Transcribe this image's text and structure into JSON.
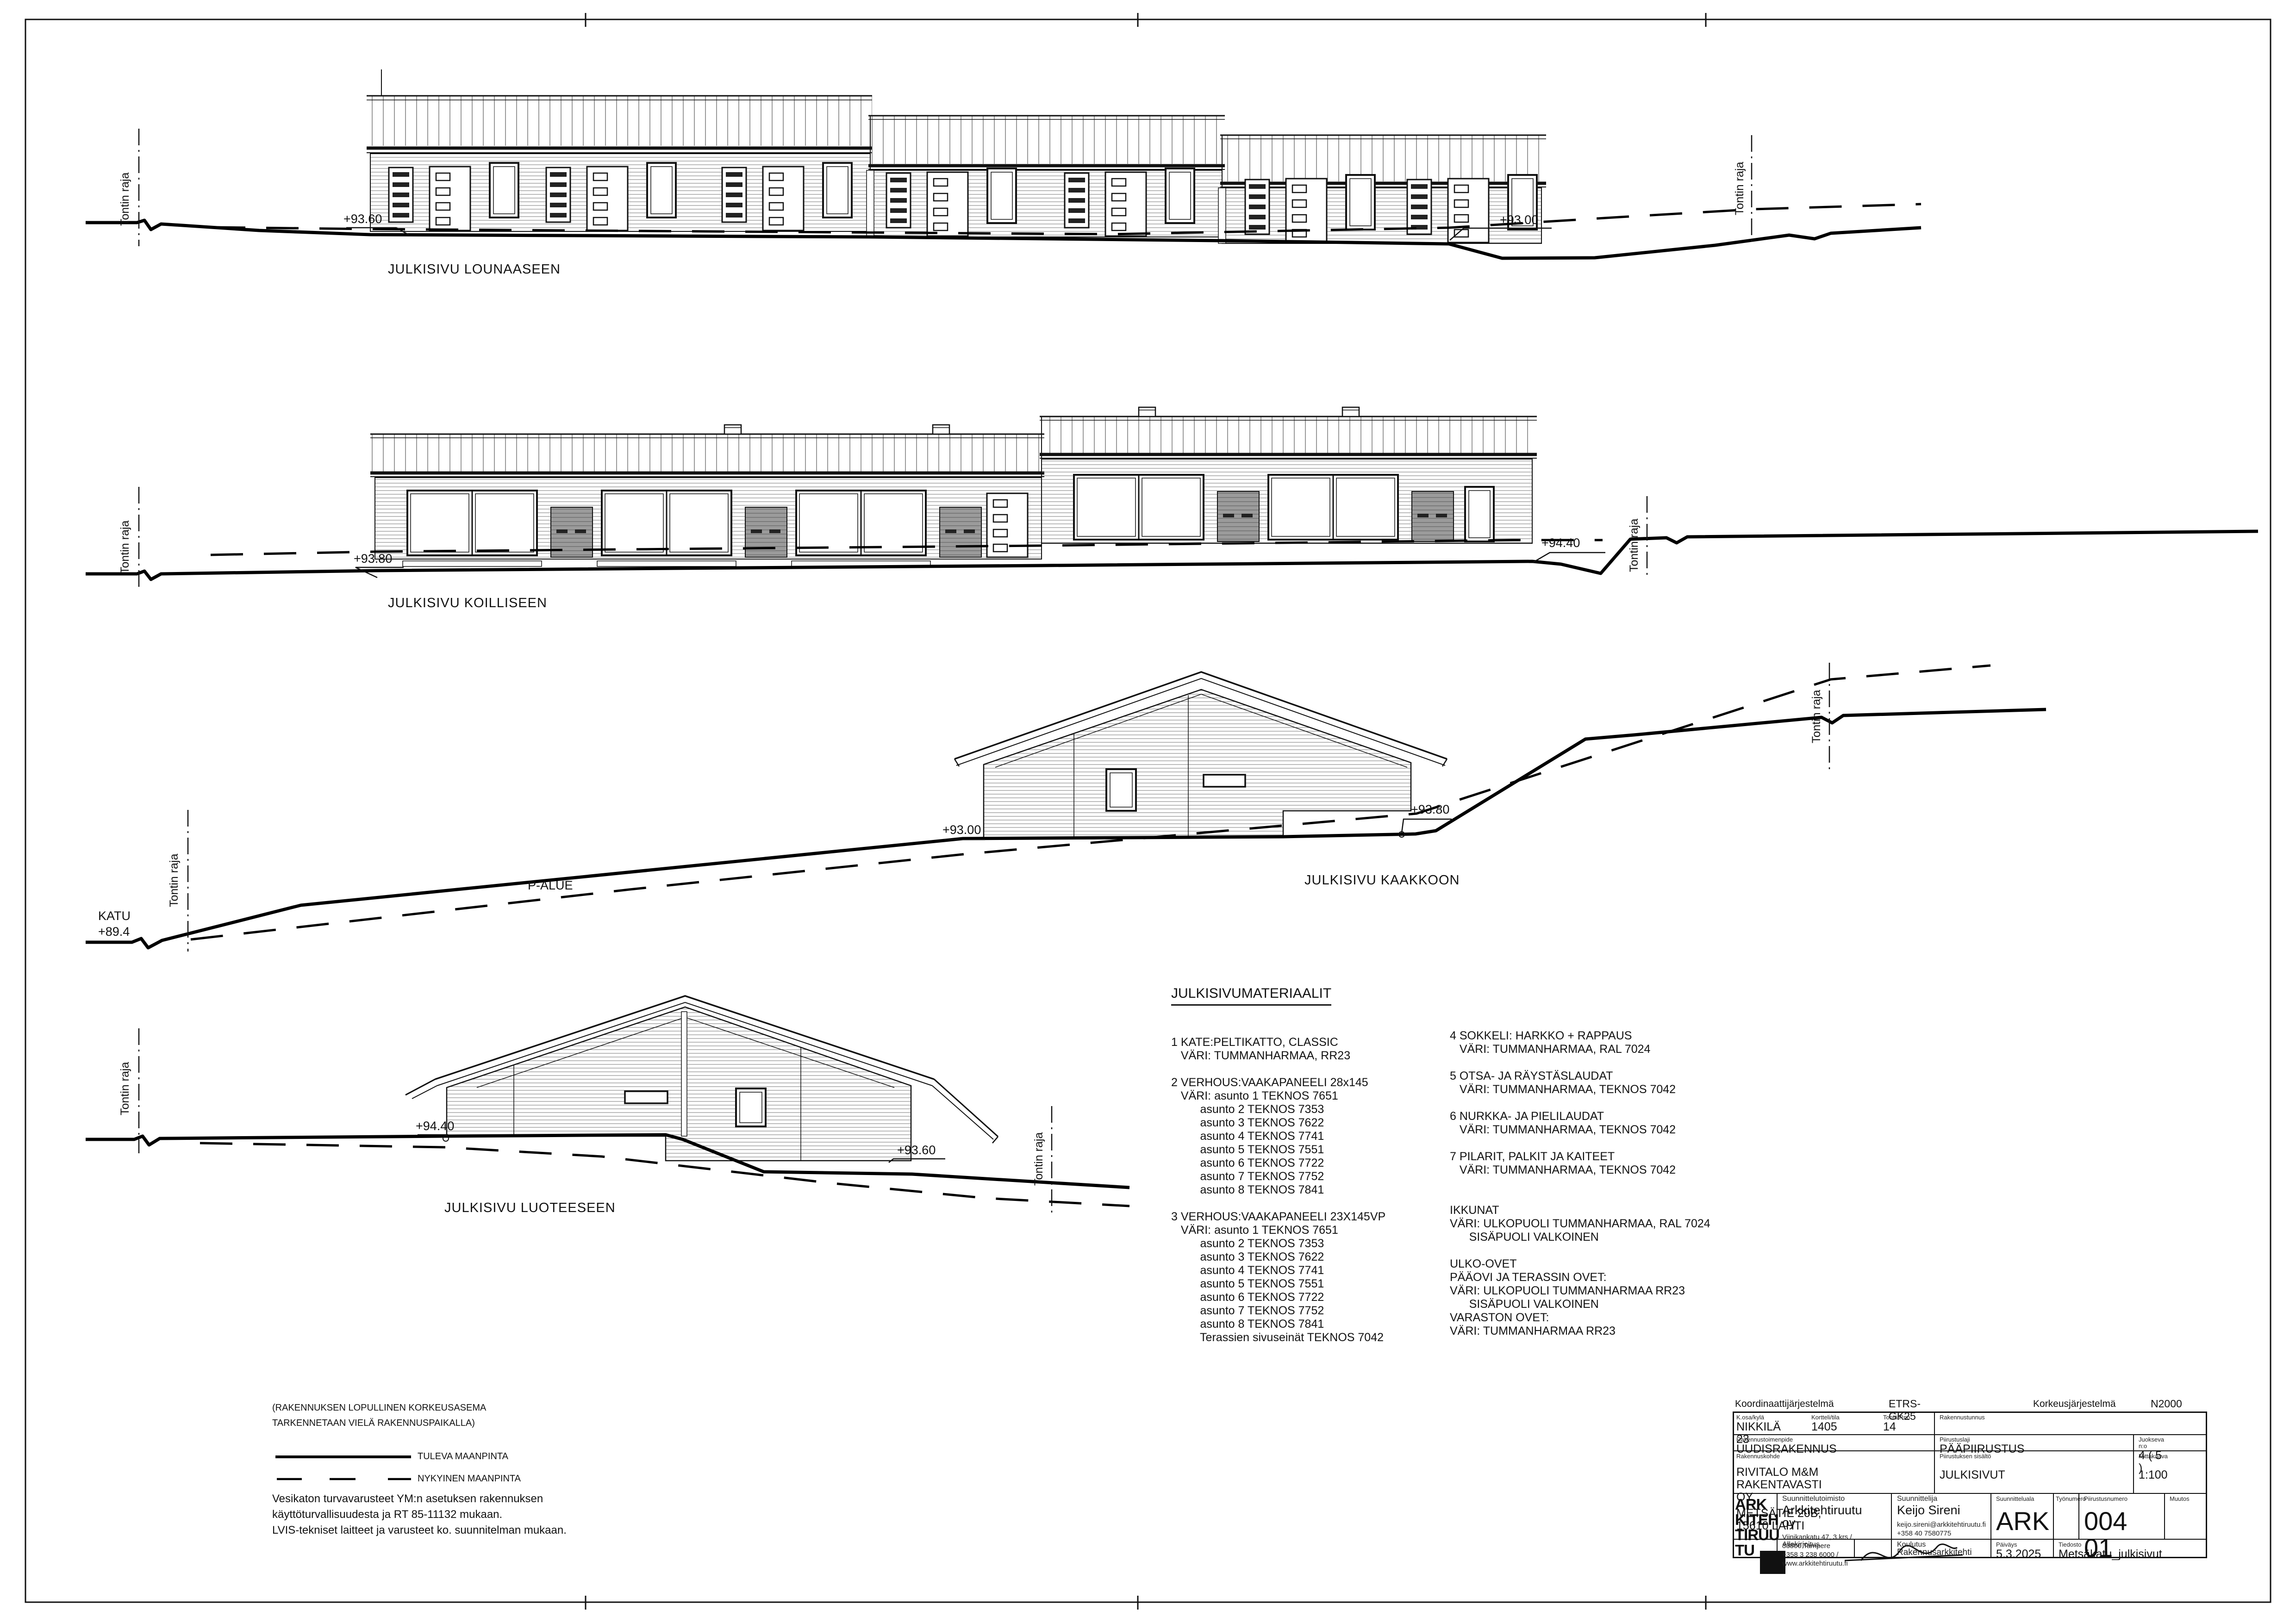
{
  "labels": {
    "boundary": "Tontin raja",
    "street": "KATU",
    "street_level": "+89.4",
    "parking": "P-ALUE"
  },
  "elevations": [
    {
      "title": "JULKISIVU LOUNAASEEN",
      "levels": {
        "left": "+93.60",
        "right": "+93.00"
      }
    },
    {
      "title": "JULKISIVU KOILLISEEN",
      "levels": {
        "left": "+93.80",
        "right": "+94.40"
      }
    },
    {
      "title": "JULKISIVU KAAKKOON",
      "levels": {
        "left": "+93.00",
        "right": "+93.80"
      }
    },
    {
      "title": "JULKISIVU LUOTEESEEN",
      "levels": {
        "left": "+94.40",
        "right": "+93.60"
      }
    }
  ],
  "materials": {
    "title": "JULKISIVUMATERIAALIT",
    "column1": [
      "1 KATE:PELTIKATTO, CLASSIC",
      "   VÄRI: TUMMANHARMAA, RR23",
      "",
      "2 VERHOUS:VAAKAPANEELI 28x145",
      "   VÄRI: asunto 1 TEKNOS 7651",
      "         asunto 2 TEKNOS 7353",
      "         asunto 3 TEKNOS 7622",
      "         asunto 4 TEKNOS 7741",
      "         asunto 5 TEKNOS 7551",
      "         asunto 6 TEKNOS 7722",
      "         asunto 7 TEKNOS 7752",
      "         asunto 8 TEKNOS 7841",
      "",
      "3 VERHOUS:VAAKAPANEELI 23X145VP",
      "   VÄRI: asunto 1 TEKNOS 7651",
      "         asunto 2 TEKNOS 7353",
      "         asunto 3 TEKNOS 7622",
      "         asunto 4 TEKNOS 7741",
      "         asunto 5 TEKNOS 7551",
      "         asunto 6 TEKNOS 7722",
      "         asunto 7 TEKNOS 7752",
      "         asunto 8 TEKNOS 7841",
      "         Terassien sivuseinät TEKNOS 7042"
    ],
    "column2": [
      "4 SOKKELI: HARKKO + RAPPAUS",
      "   VÄRI: TUMMANHARMAA, RAL 7024",
      "",
      "5 OTSA- JA RÄYSTÄSLAUDAT",
      "   VÄRI: TUMMANHARMAA, TEKNOS 7042",
      "",
      "6 NURKKA- JA PIELILAUDAT",
      "   VÄRI: TUMMANHARMAA, TEKNOS 7042",
      "",
      "7 PILARIT, PALKIT JA KAITEET",
      "   VÄRI: TUMMANHARMAA, TEKNOS 7042",
      "",
      "",
      "IKKUNAT",
      "VÄRI: ULKOPUOLI TUMMANHARMAA, RAL 7024",
      "      SISÄPUOLI VALKOINEN",
      "",
      "ULKO-OVET",
      "PÄÄOVI JA TERASSIN OVET:",
      "VÄRI: ULKOPUOLI TUMMANHARMAA RR23",
      "      SISÄPUOLI VALKOINEN",
      "VARASTON OVET:",
      "VÄRI: TUMMANHARMAA RR23"
    ]
  },
  "site_note": [
    "(RAKENNUKSEN LOPULLINEN KORKEUSASEMA",
    "TARKENNETAAN VIELÄ RAKENNUSPAIKALLA)"
  ],
  "legend": {
    "future_ground": "TULEVA MAANPINTA",
    "existing_ground": "NYKYINEN MAANPINTA"
  },
  "general_notes": [
    "Vesikaton turvavarusteet YM:n asetuksen rakennuksen",
    "käyttöturvallisuudesta ja RT 85-11132 mukaan.",
    "LVIS-tekniset laitteet ja varusteet ko. suunnitelman mukaan."
  ],
  "title_block": {
    "coordinate_system_label": "Koordinaattijärjestelmä",
    "coordinate_system": "ETRS-GK25",
    "height_system_label": "Korkeusjärjestelmä",
    "height_system": "N2000",
    "district_label": "K.osa/kylä",
    "district": "NIKKILÄ 23",
    "block_label": "Kortteli/tila",
    "block": "1405",
    "plot_label": "Tontti/Rno",
    "plot": "14",
    "building_id_label": "Rakennustunnus",
    "action_label": "Rakennustoimenpide",
    "action": "UUDISRAKENNUS",
    "drawing_type_label": "Piirustuslaji",
    "drawing_type": "PÄÄPIIRUSTUS",
    "running_no_label": "Juokseva n:o",
    "running_no": "4 ( 5 )",
    "project_label": "Rakennuskohde",
    "project_line1": "RIVITALO M&M RAKENTAVASTI OY",
    "project_line2": "METSÄTIE 20B, 15610 LAHTI",
    "content_label": "Piirustuksen sisältö",
    "content": "JULKISIVUT",
    "scale_label": "Mittakaava",
    "scale": "1:100",
    "office_label": "Suunnittelutoimisto",
    "office_name": "Arkkitehtiruutu oy",
    "office_address": "Viinikankatu 47, 3.krs / 33800 Tampere",
    "office_phone_web": "+358 3 238 6000 / www.arkkitehtiruutu.fi",
    "designer_label": "Suunnittelija",
    "designer_name": "Keijo Sireni",
    "designer_email": "keijo.sireni@arkkitehtiruutu.fi",
    "designer_phone": "+358 40 7580775",
    "signature_label": "Allekirjoitus",
    "education_label": "Koulutus",
    "education": "Rakennusarkkitehti",
    "field_label": "Suunnitteluala",
    "field": "ARK",
    "work_no_label": "Työnumero",
    "drawing_no_label": "Piirustusnumero",
    "drawing_no": "004 01",
    "revision_label": "Muutos",
    "date_label": "Päiväys",
    "date": "5.3.2025",
    "file_label": "Tiedosto",
    "file": "Metsäkatu_julkisivut",
    "logo_lines": [
      "ARK",
      "KITEH",
      "TIRUU",
      "TU"
    ]
  }
}
